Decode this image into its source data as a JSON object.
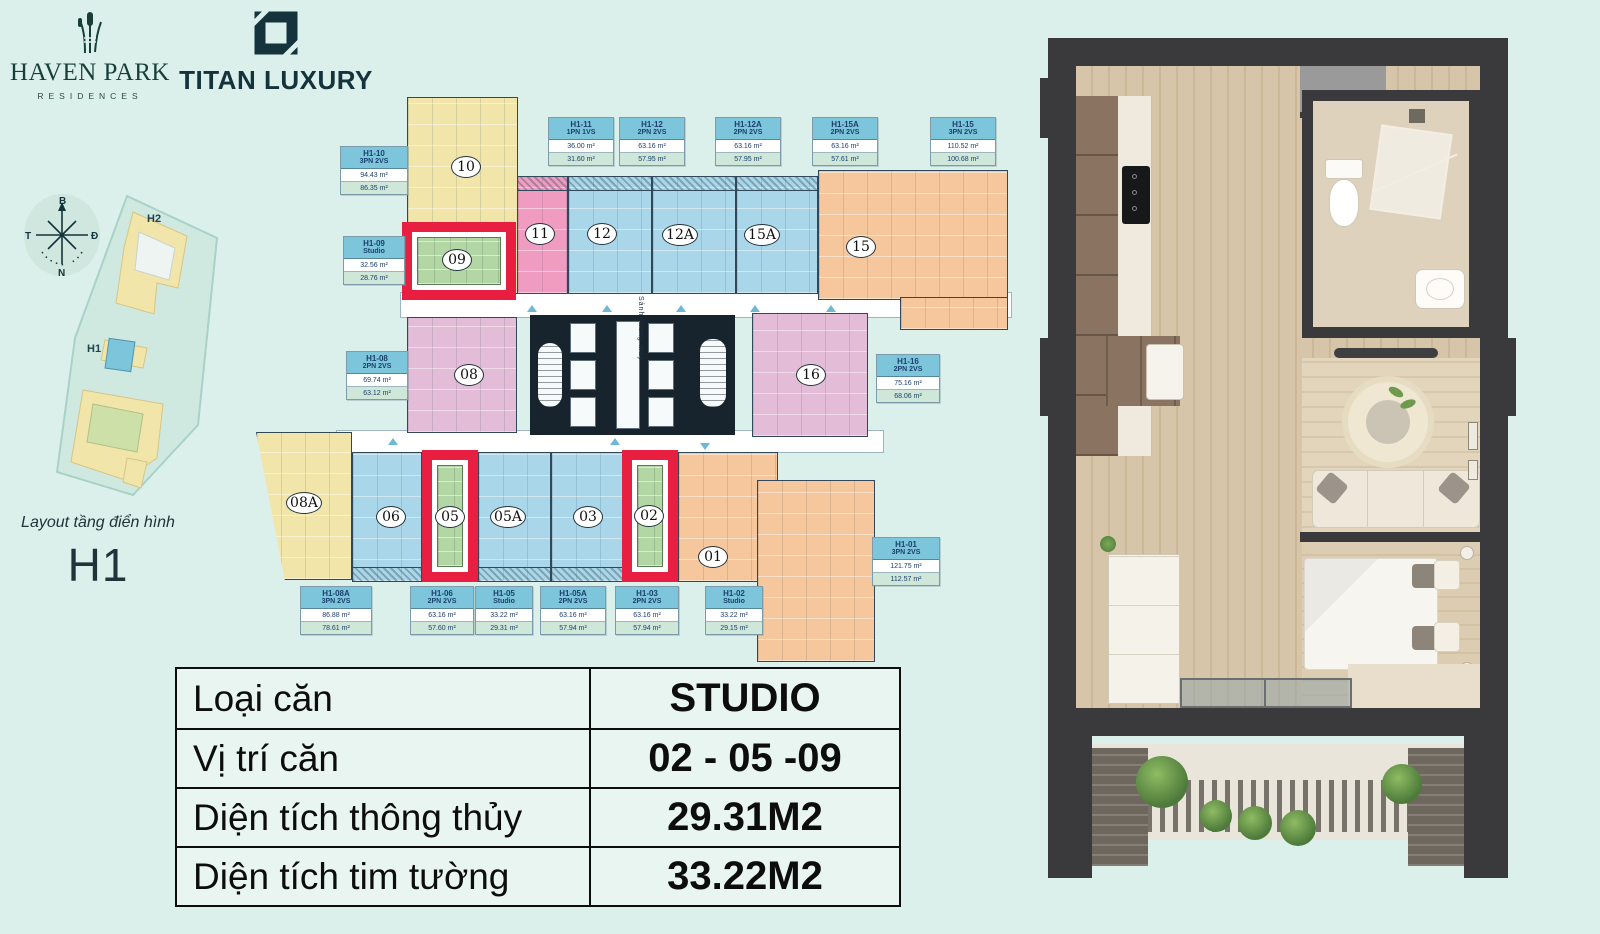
{
  "brand": {
    "haven_park_title": "HAVEN PARK",
    "haven_park_subtitle": "RESIDENCES",
    "titan_title": "TITAN LUXURY"
  },
  "compass": {
    "north": "B",
    "east": "Đ",
    "south": "N",
    "west": "T"
  },
  "site_map": {
    "building_top": "H2",
    "building_mid": "H1"
  },
  "caption": {
    "line1": "Layout tầng điển hình",
    "line2": "H1"
  },
  "floor_plan": {
    "corridor_label": "Sảnh thang máy",
    "highlighted_units": [
      "09",
      "05",
      "02"
    ],
    "units": [
      {
        "no": "10"
      },
      {
        "no": "11"
      },
      {
        "no": "12"
      },
      {
        "no": "12A"
      },
      {
        "no": "15A"
      },
      {
        "no": "15"
      },
      {
        "no": "09"
      },
      {
        "no": "08"
      },
      {
        "no": "16"
      },
      {
        "no": "08A"
      },
      {
        "no": "06"
      },
      {
        "no": "05"
      },
      {
        "no": "05A"
      },
      {
        "no": "03"
      },
      {
        "no": "02"
      },
      {
        "no": "01"
      }
    ],
    "cards": [
      {
        "code": "H1-10",
        "type": "3PN 2VS",
        "area_gross": "94.43 m²",
        "area_net": "86.35 m²"
      },
      {
        "code": "H1-09",
        "type": "Studio",
        "area_gross": "32.56 m²",
        "area_net": "28.76 m²"
      },
      {
        "code": "H1-11",
        "type": "1PN 1VS",
        "area_gross": "36.00 m²",
        "area_net": "31.60 m²"
      },
      {
        "code": "H1-12",
        "type": "2PN 2VS",
        "area_gross": "63.16 m²",
        "area_net": "57.95 m²"
      },
      {
        "code": "H1-12A",
        "type": "2PN 2VS",
        "area_gross": "63.16 m²",
        "area_net": "57.95 m²"
      },
      {
        "code": "H1-15A",
        "type": "2PN 2VS",
        "area_gross": "63.16 m²",
        "area_net": "57.61 m²"
      },
      {
        "code": "H1-15",
        "type": "3PN 2VS",
        "area_gross": "110.52 m²",
        "area_net": "100.68 m²"
      },
      {
        "code": "H1-08",
        "type": "2PN 2VS",
        "area_gross": "69.74 m²",
        "area_net": "63.12 m²"
      },
      {
        "code": "H1-16",
        "type": "2PN 2VS",
        "area_gross": "75.16 m²",
        "area_net": "68.06 m²"
      },
      {
        "code": "H1-01",
        "type": "3PN 2VS",
        "area_gross": "121.75 m²",
        "area_net": "112.57 m²"
      },
      {
        "code": "H1-08A",
        "type": "3PN 2VS",
        "area_gross": "86.88 m²",
        "area_net": "78.61 m²"
      },
      {
        "code": "H1-06",
        "type": "2PN 2VS",
        "area_gross": "63.16 m²",
        "area_net": "57.60 m²"
      },
      {
        "code": "H1-05",
        "type": "Studio",
        "area_gross": "33.22 m²",
        "area_net": "29.31 m²"
      },
      {
        "code": "H1-05A",
        "type": "2PN 2VS",
        "area_gross": "63.16 m²",
        "area_net": "57.94 m²"
      },
      {
        "code": "H1-03",
        "type": "2PN 2VS",
        "area_gross": "63.16 m²",
        "area_net": "57.94 m²"
      },
      {
        "code": "H1-02",
        "type": "Studio",
        "area_gross": "33.22 m²",
        "area_net": "29.15 m²"
      }
    ]
  },
  "summary_table": {
    "rows": [
      {
        "label": "Loại căn",
        "value": "STUDIO"
      },
      {
        "label": "Vị trí căn",
        "value": "02 - 05 -09"
      },
      {
        "label": "Diện tích thông thủy",
        "value": "29.31M2"
      },
      {
        "label": "Diện tích tim tường",
        "value": "33.22M2"
      }
    ]
  },
  "colors": {
    "background": "#dcf0eb",
    "highlight_red": "#e81f41",
    "card_header_blue": "#7cc5da",
    "unit_blue": "#a9d6e8",
    "unit_yellow": "#f2e5a9",
    "unit_pink": "#f09cc0",
    "unit_lavender": "#e3bcd8",
    "unit_orange": "#f6c69c",
    "unit_green": "#b3d6a5",
    "wall_dark": "#17242e"
  }
}
